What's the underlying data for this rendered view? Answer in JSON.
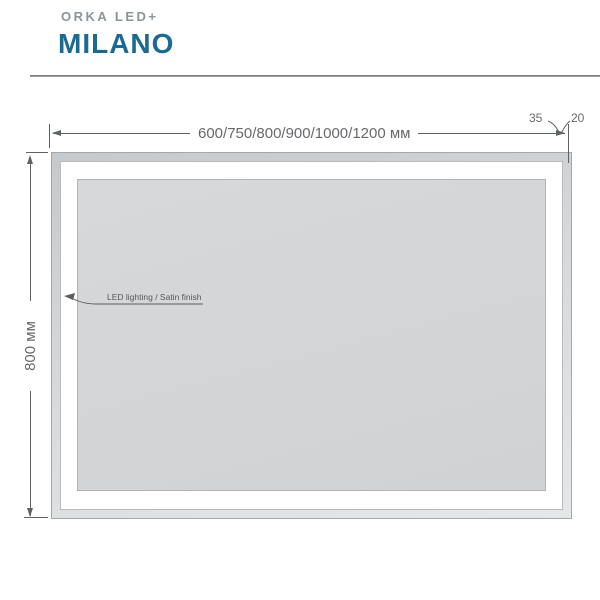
{
  "header": {
    "brand": "ORKA LED+",
    "model": "MILANO",
    "brand_color": "#8d949a",
    "model_color": "#1a6a91"
  },
  "diagram": {
    "type": "technical-drawing",
    "product": "LED mirror front view",
    "width_dimension": "600/750/800/900/1000/1200 мм",
    "height_dimension": "800 мм",
    "detail_dimension_35": "35",
    "detail_dimension_20": "20",
    "feature_label": "LED lighting / Satin finish",
    "colors": {
      "mirror_surface": "#d2d4d6",
      "frame_band_dark": "#c6c9cb",
      "frame_band_light": "#e6e7e9",
      "satin_band": "#ffffff",
      "dimension_line": "#5f6366",
      "dimension_text": "#67696c"
    }
  }
}
